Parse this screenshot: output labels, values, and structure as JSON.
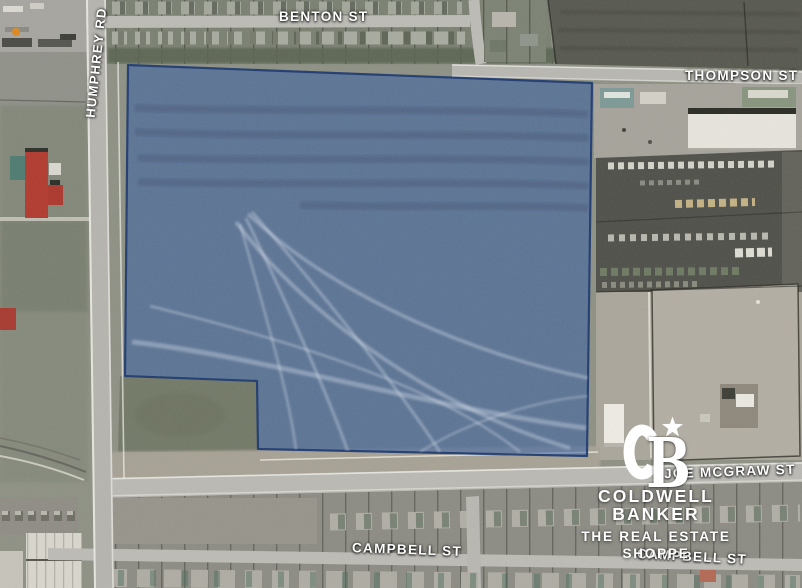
{
  "map": {
    "streets": [
      {
        "id": "benton",
        "label": "BENTON ST"
      },
      {
        "id": "thompson",
        "label": "THOMPSON ST"
      },
      {
        "id": "humphrey",
        "label": "HUMPHREY RD"
      },
      {
        "id": "joe-mcgraw",
        "label": "JOE MCGRAW ST"
      },
      {
        "id": "campbell-west",
        "label": "CAMPBELL ST"
      },
      {
        "id": "campbell-east",
        "label": "CAMPBELL ST"
      }
    ],
    "parcel": {
      "vertices": "128,65 592,83 587,456 258,449 257,381 125,376",
      "fill": "rgba(47,92,164,0.52)",
      "stroke": "rgba(26,54,110,0.9)"
    }
  },
  "branding": {
    "monogram": {
      "c": "C",
      "b": "B"
    },
    "company": "COLDWELL BANKER",
    "tagline_line1": "THE REAL ESTATE",
    "tagline_line2": "SHOPPE",
    "text_color": "#FFFFFF"
  }
}
